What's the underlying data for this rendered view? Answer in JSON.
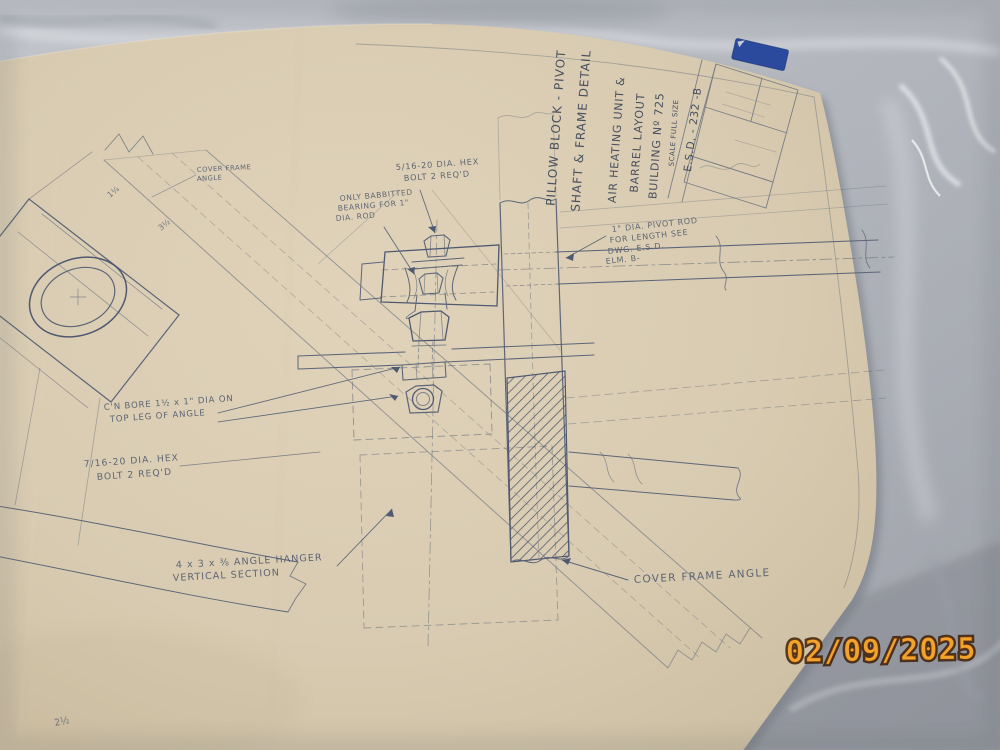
{
  "photo": {
    "date_stamp": "02/09/2025"
  },
  "title_block": {
    "title_line1": "PILLOW BLOCK - PIVOT",
    "title_line2": "SHAFT & FRAME DETAIL",
    "project_line1": "AIR HEATING UNIT &",
    "project_line2": "BARREL LAYOUT",
    "project_line3": "BUILDING Nº 725",
    "scale": "SCALE FULL SIZE",
    "drawing_number": "E.S.D. -  232  -B"
  },
  "annotations": {
    "bolt_top_line1": "5/16-20 DIA. HEX",
    "bolt_top_line2": "BOLT 2 REQ'D",
    "babbitt_line1": "ONLY BABBITTED",
    "babbitt_line2": "BEARING FOR 1\"",
    "babbitt_line3": "DIA. ROD",
    "pivot_line1": "1\" DIA. PIVOT ROD",
    "pivot_line2": "FOR LENGTH SEE",
    "pivot_line3": "DWG. E.S.D.",
    "pivot_line4": "ELM. B-",
    "cbore_line1": "C'N BORE 1½ x 1\" DIA ON",
    "cbore_line2": "TOP LEG OF ANGLE",
    "bolt_bottom_line1": "7/16-20 DIA. HEX",
    "bolt_bottom_line2": "BOLT 2 REQ'D",
    "hanger_line1": "4 x 3 x ⅜ ANGLE HANGER",
    "hanger_line2": "VERTICAL SECTION",
    "cover_frame_line1": "COVER FRAME",
    "cover_frame_line2": "ANGLE",
    "cover_frame_angle": "COVER FRAME ANGLE"
  },
  "dimensions": {
    "dim_band1": "1¼",
    "dim_band2": "3½",
    "dim_bottom": "2½"
  },
  "colors": {
    "paper": "#d8cbb1",
    "pencil": "#5d6678",
    "marble": "#b4b7bd",
    "tape_blue": "#2b4a9e",
    "stamp_orange": "#f2a32b"
  }
}
